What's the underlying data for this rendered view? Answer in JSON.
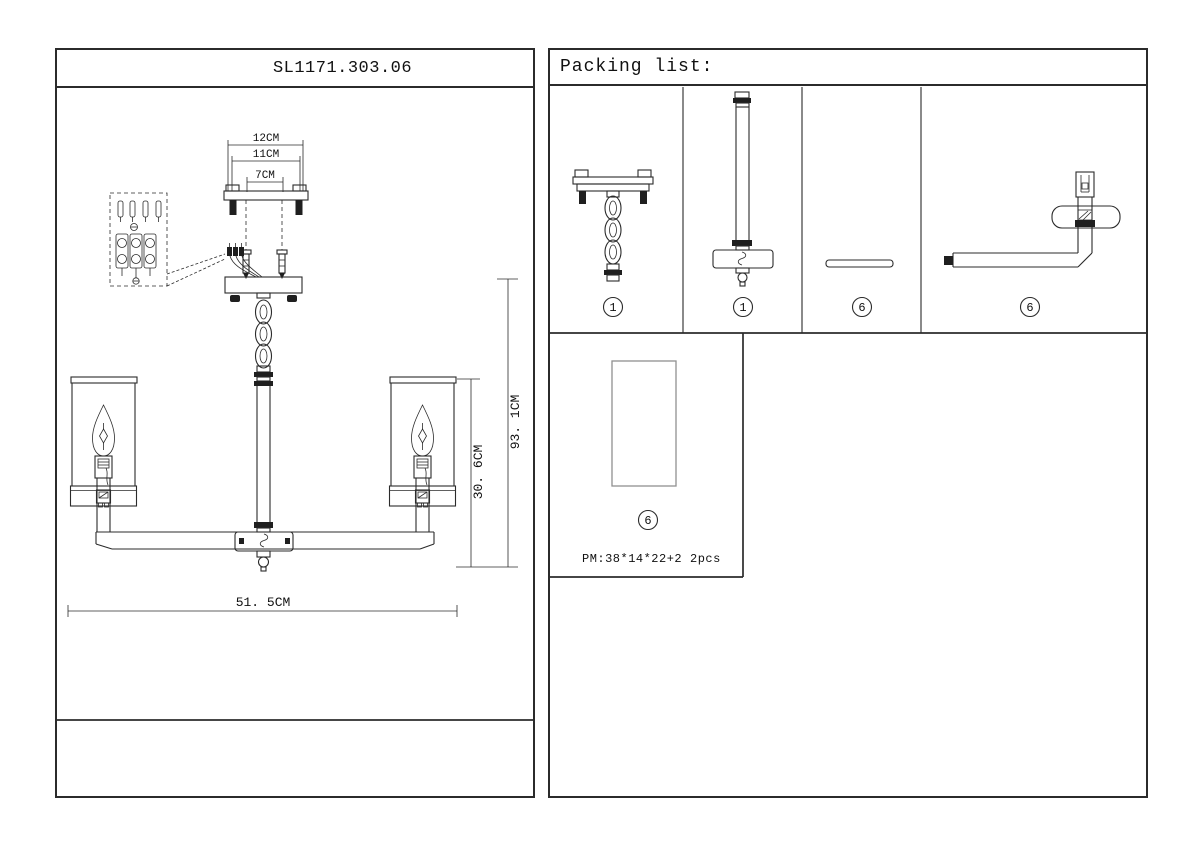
{
  "left_panel": {
    "model": "SL1171.303.06",
    "dimensions": {
      "bracket_outer": "12CM",
      "bracket_mid": "11CM",
      "bracket_holes": "7CM",
      "lamp_height": "30. 6CM",
      "total_height": "93. 1CM",
      "total_width": "51. 5CM"
    }
  },
  "packing": {
    "title": "Packing list:",
    "items": [
      {
        "number": "1"
      },
      {
        "number": "1"
      },
      {
        "number": "6"
      },
      {
        "number": "6"
      },
      {
        "number": "6",
        "pm": "PM:38*14*22+2",
        "qty": "2pcs"
      }
    ]
  },
  "colors": {
    "line": "#2b2b2b",
    "background": "#ffffff"
  }
}
